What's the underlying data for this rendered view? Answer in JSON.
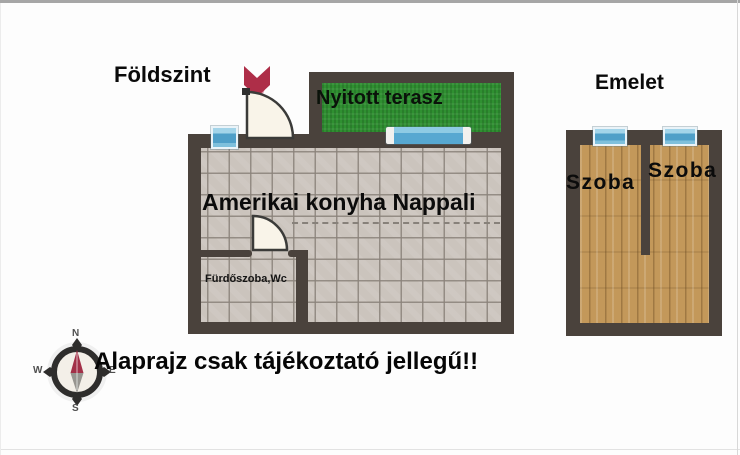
{
  "ground_floor": {
    "title": "Földszint",
    "terrace_label": "Nyitott terasz",
    "living_room_label": "Amerikai konyha Nappali",
    "bathroom_label": "Fürdőszoba,Wc"
  },
  "upper_floor": {
    "title": "Emelet",
    "left_room_label": "Szoba",
    "right_room_label": "Szoba"
  },
  "compass": {
    "n": "N",
    "s": "S",
    "w": "W",
    "e": "E"
  },
  "disclaimer": "Alaprajz csak tájékoztató jellegű!!",
  "colors": {
    "wall_brown": "#4a423c",
    "terrace_green": "#2f9031",
    "tile_floor": "#cbc4bd",
    "wood_floor": "#c3985a",
    "window_blue": "#57a8d1",
    "door_fill": "#f9f4e9",
    "entrance_arrow_red": "#ae2e48",
    "compass_needle_red": "#a23048"
  }
}
